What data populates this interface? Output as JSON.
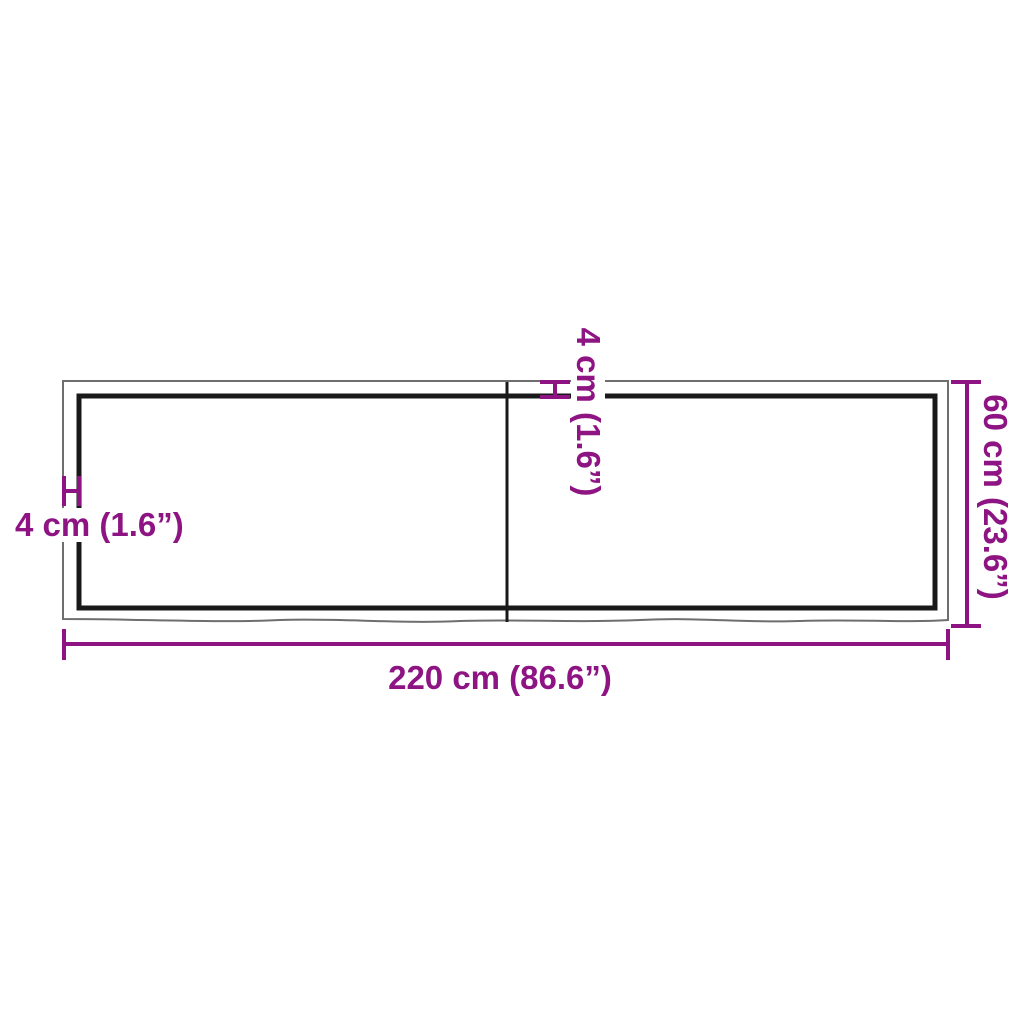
{
  "diagram": {
    "labels": {
      "thickness_left": "4 cm (1.6”)",
      "thickness_top": "4 cm (1.6”)",
      "height": "60 cm (23.6”)",
      "width": "220 cm (86.6”)"
    }
  },
  "colors": {
    "dimension_accent": "#8E1483",
    "board_outline": "#6E6E6E",
    "panel_outline": "#191919",
    "canvas_background": "#FFFFFF"
  }
}
